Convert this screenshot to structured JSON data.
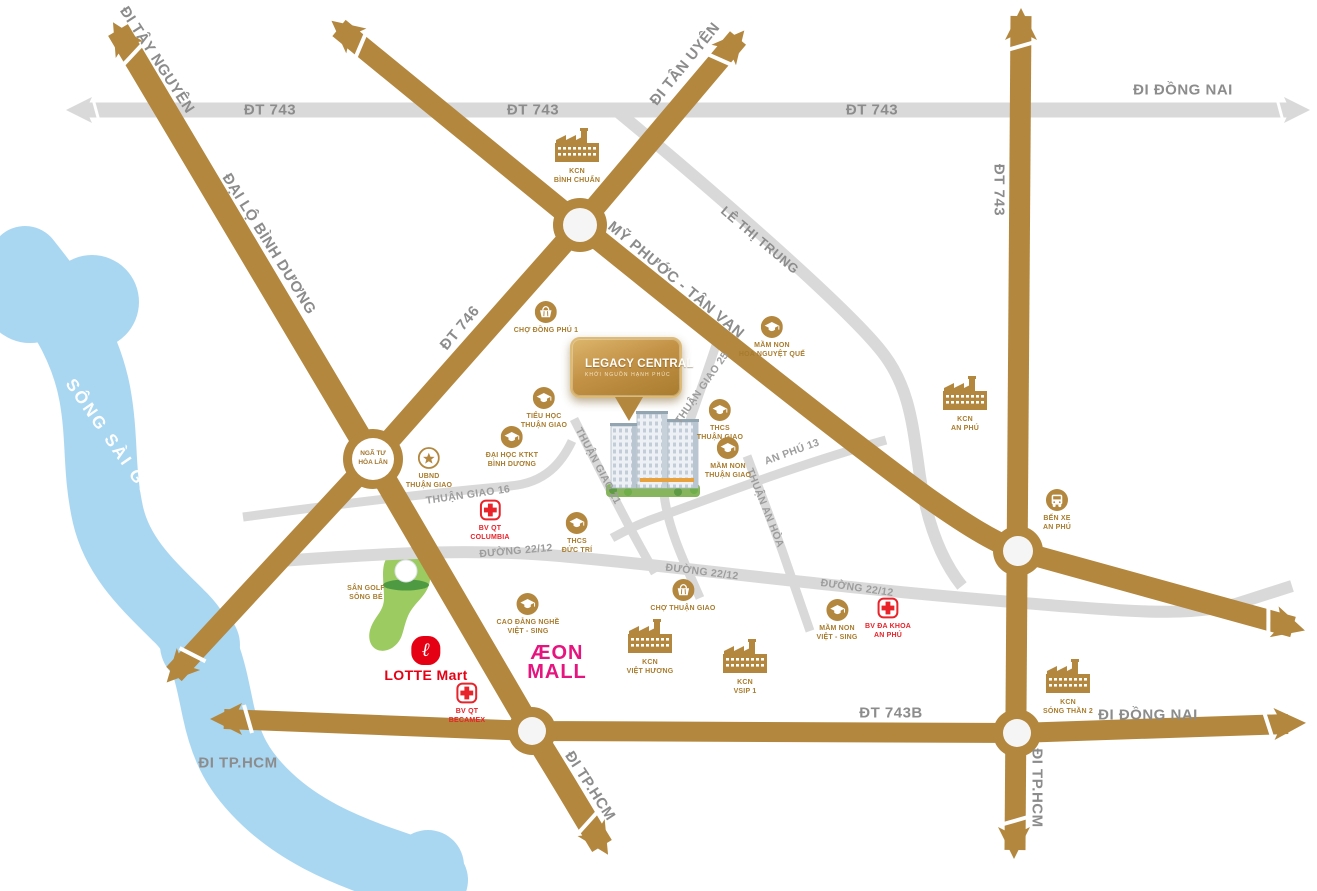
{
  "title": "Legacy Central location map",
  "colors": {
    "road_main": "#b3873e",
    "road_minor": "#d9d9d9",
    "river": "#a9d7f2",
    "golf_green": "#9ccb62",
    "label_gray": "#8c8c8c",
    "landmark_brown": "#a87c2e",
    "hospital_red": "#e8232a",
    "lotte_red": "#e60013",
    "aeon_pink": "#e5147e"
  },
  "project": {
    "logo_title": "LEGACY CENTRAL",
    "logo_subtitle": "KHỞI NGUỒN HẠNH PHÚC"
  },
  "junction": {
    "label": "NGÃ TƯ\nHÒA LÂN"
  },
  "brands": {
    "lotte": {
      "badge_glyph": "ℓ",
      "text": "LOTTE Mart"
    },
    "aeon": {
      "line1": "ÆON",
      "line2": "MALL"
    }
  },
  "road_labels": [
    {
      "name": "di-tay-nguyen",
      "text": "ĐI TÂY NGUYÊN",
      "x": 157,
      "y": 60,
      "r": 57,
      "cls": "rl-lg"
    },
    {
      "name": "dt743-top-1",
      "text": "ĐT 743",
      "x": 270,
      "y": 110,
      "r": 0,
      "cls": "rl-lg"
    },
    {
      "name": "dt743-top-2",
      "text": "ĐT 743",
      "x": 533,
      "y": 110,
      "r": 0,
      "cls": "rl-lg"
    },
    {
      "name": "dt743-top-3",
      "text": "ĐT 743",
      "x": 872,
      "y": 110,
      "r": 0,
      "cls": "rl-lg"
    },
    {
      "name": "di-dong-nai-top",
      "text": "ĐI ĐỒNG NAI",
      "x": 1183,
      "y": 90,
      "r": 0,
      "cls": "rl-lg"
    },
    {
      "name": "di-tan-uyen",
      "text": "ĐI TÂN UYÊN",
      "x": 685,
      "y": 64,
      "r": -51,
      "cls": "rl-lg"
    },
    {
      "name": "dai-lo-binh-duong",
      "text": "ĐẠI LỘ BÌNH DƯƠNG",
      "x": 269,
      "y": 244,
      "r": 58,
      "cls": "rl-lg"
    },
    {
      "name": "dt746",
      "text": "ĐT 746",
      "x": 460,
      "y": 328,
      "r": -50,
      "cls": "rl-lg"
    },
    {
      "name": "my-phuoc-tan-van",
      "text": "MỸ PHƯỚC - TÂN VẠN",
      "x": 676,
      "y": 280,
      "r": 40,
      "cls": "rl-lg"
    },
    {
      "name": "le-thi-trung",
      "text": "LÊ THỊ TRUNG",
      "x": 760,
      "y": 240,
      "r": 40,
      "cls": "rl-md"
    },
    {
      "name": "dt743-right",
      "text": "ĐT 743",
      "x": 999,
      "y": 190,
      "r": 90,
      "cls": "rl-lg"
    },
    {
      "name": "thuan-giao-25",
      "text": "THUẬN GIAO 25",
      "x": 702,
      "y": 388,
      "r": -55,
      "cls": "rl-sm"
    },
    {
      "name": "thuan-giao-21",
      "text": "THUẬN GIAO 21",
      "x": 598,
      "y": 466,
      "r": 62,
      "cls": "rl-sm"
    },
    {
      "name": "thuan-giao-16",
      "text": "THUẬN GIAO 16",
      "x": 468,
      "y": 495,
      "r": -8,
      "cls": "rl-sm"
    },
    {
      "name": "an-phu-13",
      "text": "AN PHÚ 13",
      "x": 792,
      "y": 452,
      "r": -20,
      "cls": "rl-sm"
    },
    {
      "name": "thuan-an-hoa",
      "text": "THUẬN AN HÒA",
      "x": 765,
      "y": 508,
      "r": 68,
      "cls": "rl-sm"
    },
    {
      "name": "duong-2212-1",
      "text": "ĐƯỜNG 22/12",
      "x": 516,
      "y": 551,
      "r": -5,
      "cls": "rl-sm"
    },
    {
      "name": "duong-2212-2",
      "text": "ĐƯỜNG 22/12",
      "x": 702,
      "y": 572,
      "r": 7,
      "cls": "rl-sm"
    },
    {
      "name": "duong-2212-3",
      "text": "ĐƯỜNG 22/12",
      "x": 857,
      "y": 588,
      "r": 8,
      "cls": "rl-sm"
    },
    {
      "name": "dt743b",
      "text": "ĐT 743B",
      "x": 891,
      "y": 713,
      "r": 0,
      "cls": "rl-lg"
    },
    {
      "name": "di-dong-nai-bottom",
      "text": "ĐI ĐỒNG NAI",
      "x": 1148,
      "y": 715,
      "r": 0,
      "cls": "rl-lg"
    },
    {
      "name": "di-tphcm-left",
      "text": "ĐI TP.HCM",
      "x": 238,
      "y": 763,
      "r": 0,
      "cls": "rl-lg"
    },
    {
      "name": "di-tphcm-mid",
      "text": "ĐI TP.HCM",
      "x": 590,
      "y": 786,
      "r": 57,
      "cls": "rl-lg"
    },
    {
      "name": "di-tphcm-right",
      "text": "ĐI TP.HCM",
      "x": 1037,
      "y": 788,
      "r": 90,
      "cls": "rl-lg"
    },
    {
      "name": "song-sai-gon",
      "text": "SÔNG SÀI GÒN",
      "x": 114,
      "y": 445,
      "r": 55,
      "cls": "rl-river"
    }
  ],
  "landmarks": [
    {
      "name": "kcn-binh-chuan",
      "icon": "factory",
      "x": 577,
      "y": 128,
      "label": "KCN\nBÌNH CHUẨN"
    },
    {
      "name": "cho-dong-phu-1",
      "icon": "market",
      "x": 546,
      "y": 301,
      "label": "CHỢ ĐỒNG PHÚ 1"
    },
    {
      "name": "mam-non-hoa-nguyet-que",
      "icon": "school",
      "x": 772,
      "y": 316,
      "label": "MẦM NON\nHOA NGUYỆT QUẾ"
    },
    {
      "name": "thcs-thuan-giao",
      "icon": "school",
      "x": 720,
      "y": 399,
      "label": "THCS\nTHUẬN GIAO"
    },
    {
      "name": "mam-non-thuan-giao",
      "icon": "school",
      "x": 728,
      "y": 437,
      "label": "MẦM NON\nTHUẬN GIAO"
    },
    {
      "name": "tieu-hoc-thuan-giao",
      "icon": "school",
      "x": 544,
      "y": 387,
      "label": "TIỂU HỌC\nTHUẬN GIAO"
    },
    {
      "name": "dai-hoc-ktkt-binh-duong",
      "icon": "school",
      "x": 512,
      "y": 426,
      "label": "ĐẠI HỌC KTKT\nBÌNH DƯƠNG"
    },
    {
      "name": "ubnd-thuan-giao",
      "icon": "star",
      "x": 429,
      "y": 447,
      "label": "UBND\nTHUẬN GIAO"
    },
    {
      "name": "bv-qt-columbia",
      "icon": "hospital",
      "x": 490,
      "y": 499,
      "label": "BV QT\nCOLUMBIA",
      "cls": "red"
    },
    {
      "name": "thcs-duc-tri",
      "icon": "school",
      "x": 577,
      "y": 512,
      "label": "THCS\nĐỨC TRÍ"
    },
    {
      "name": "kcn-an-phu",
      "icon": "factory",
      "x": 965,
      "y": 376,
      "label": "KCN\nAN PHÚ"
    },
    {
      "name": "ben-xe-an-phu",
      "icon": "bus",
      "x": 1057,
      "y": 489,
      "label": "BẾN XE\nAN PHÚ"
    },
    {
      "name": "cho-thuan-giao",
      "icon": "market",
      "x": 683,
      "y": 579,
      "label": "CHỢ THUẬN GIAO"
    },
    {
      "name": "mam-non-viet-sing",
      "icon": "school",
      "x": 837,
      "y": 599,
      "label": "MẦM NON\nVIỆT - SING"
    },
    {
      "name": "bv-da-khoa-an-phu",
      "icon": "hospital",
      "x": 888,
      "y": 597,
      "label": "BV ĐA KHOA\nAN PHÚ",
      "cls": "red"
    },
    {
      "name": "cao-dang-nghe-viet-sing",
      "icon": "school",
      "x": 528,
      "y": 593,
      "label": "CAO ĐẲNG NGHỀ\nVIỆT - SING"
    },
    {
      "name": "kcn-viet-huong",
      "icon": "factory",
      "x": 650,
      "y": 619,
      "label": "KCN\nVIỆT HƯƠNG"
    },
    {
      "name": "kcn-vsip-1",
      "icon": "factory",
      "x": 745,
      "y": 639,
      "label": "KCN\nVSIP 1"
    },
    {
      "name": "kcn-song-than-2",
      "icon": "factory",
      "x": 1068,
      "y": 659,
      "label": "KCN\nSÓNG THẦN 2"
    },
    {
      "name": "bv-qt-becamex",
      "icon": "hospital",
      "x": 467,
      "y": 682,
      "label": "BV QT\nBECAMEX",
      "cls": "red"
    },
    {
      "name": "san-golf-song-be",
      "icon": "none",
      "x": 366,
      "y": 581,
      "label": "SÂN GOLF\nSÔNG BÉ"
    }
  ]
}
